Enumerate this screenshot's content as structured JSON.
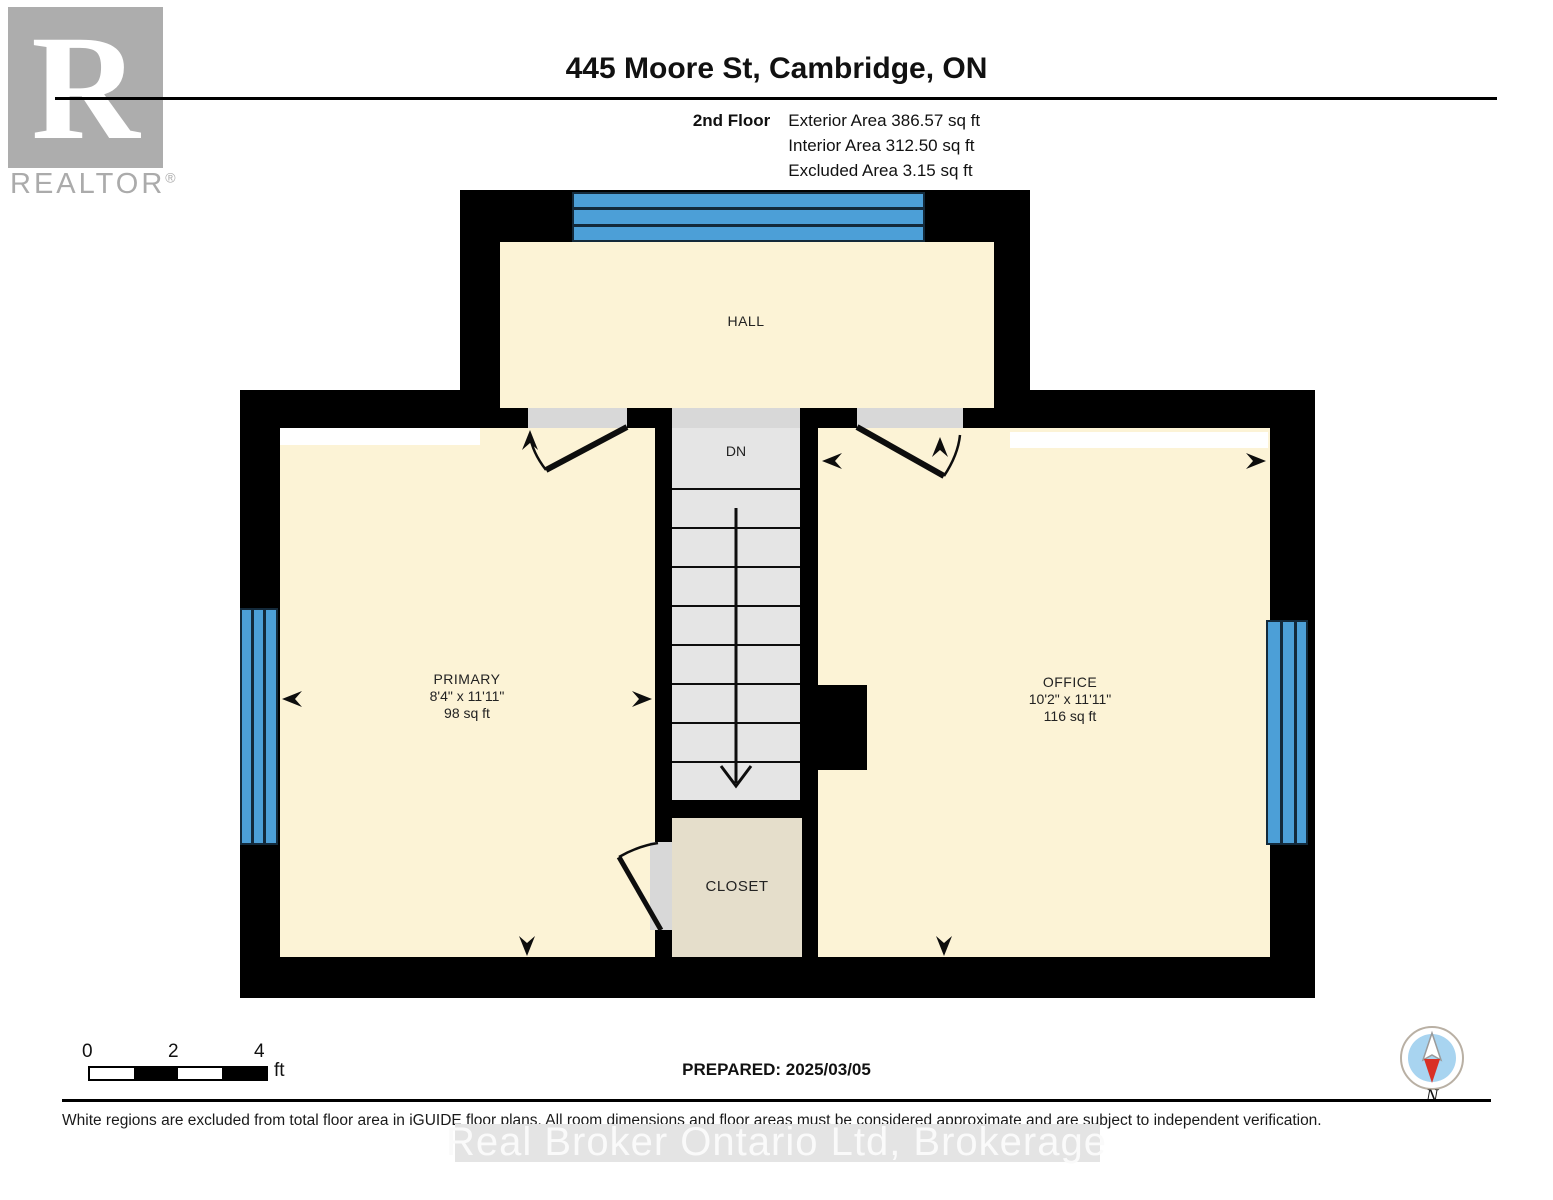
{
  "header": {
    "title": "445 Moore St, Cambridge, ON",
    "floor_label": "2nd Floor",
    "stats": [
      "Exterior Area 386.57 sq ft",
      "Interior Area 312.50 sq ft",
      "Excluded Area 3.15 sq ft"
    ]
  },
  "logo": {
    "letter": "R",
    "text": "REALTOR",
    "reg": "®"
  },
  "plan": {
    "rooms": {
      "hall": {
        "name": "HALL"
      },
      "primary": {
        "name": "PRIMARY",
        "dims": "8'4\" x 11'11\"",
        "area": "98 sq ft"
      },
      "office": {
        "name": "OFFICE",
        "dims": "10'2\" x 11'11\"",
        "area": "116 sq ft"
      },
      "closet": {
        "name": "CLOSET"
      },
      "stairs": {
        "label": "DN"
      }
    },
    "colors": {
      "wall": "#000000",
      "floor": "#FCF3D6",
      "closet_floor": "#E5DECB",
      "stairs": "#E5E5E5",
      "window": "#4C9FD7",
      "door": "#D8D8D8",
      "excluded": "#FFFFFF"
    }
  },
  "footer": {
    "scale": {
      "ticks": [
        "0",
        "2",
        "4"
      ],
      "unit": "ft"
    },
    "prepared": "PREPARED: 2025/03/05",
    "compass_label": "N",
    "disclaimer": "White regions are excluded from total floor area in iGUIDE floor plans. All room dimensions and floor areas must be considered approximate and are subject to independent verification.",
    "watermark": "Real Broker Ontario Ltd, Brokerage"
  }
}
